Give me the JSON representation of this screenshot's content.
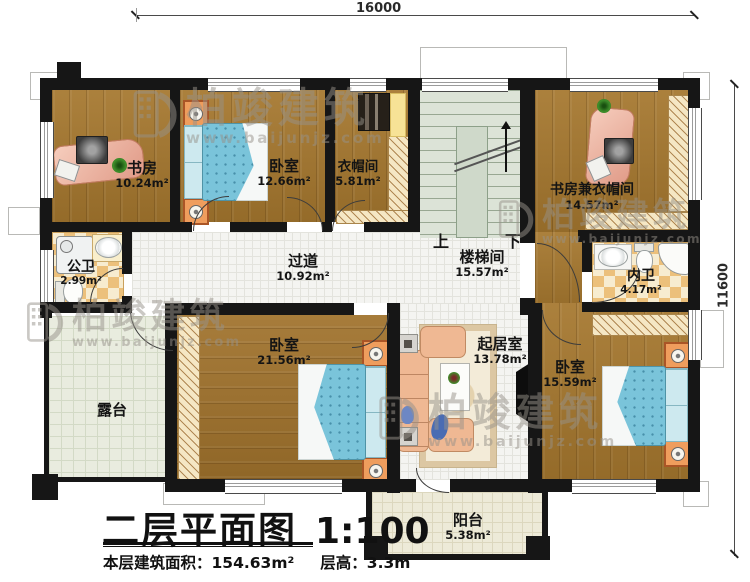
{
  "plan": {
    "dimensions": {
      "top": "16000",
      "right": "11600"
    },
    "title_block": {
      "title": "二层平面图",
      "scale": "1:100",
      "area_label": "本层建筑面积：",
      "area_value": "154.63m²",
      "height_label": "层高：",
      "height_value": "3.3m"
    },
    "stairs": {
      "up": "上",
      "down": "下"
    },
    "watermark": {
      "brand": "柏竣建筑",
      "url": "www.baijunjz.com"
    },
    "rooms": {
      "study": {
        "name": "书房",
        "area": "10.24m²"
      },
      "bedroom1": {
        "name": "卧室",
        "area": "12.66m²"
      },
      "cloakroom": {
        "name": "衣帽间",
        "area": "5.81m²"
      },
      "study_cloakroom": {
        "name": "书房兼衣帽间",
        "area": "14.57m²"
      },
      "public_bath": {
        "name": "公卫",
        "area": "2.99m²"
      },
      "corridor": {
        "name": "过道",
        "area": "10.92m²"
      },
      "stairwell": {
        "name": "楼梯间",
        "area": "15.57m²"
      },
      "private_bath": {
        "name": "内卫",
        "area": "4.17m²"
      },
      "terrace": {
        "name": "露台",
        "area": ""
      },
      "bedroom2": {
        "name": "卧室",
        "area": "21.56m²"
      },
      "living": {
        "name": "起居室",
        "area": "13.78m²"
      },
      "bedroom3": {
        "name": "卧室",
        "area": "15.59m²"
      },
      "balcony": {
        "name": "阳台",
        "area": "5.38m²"
      }
    },
    "colors": {
      "wall": "#161616",
      "wood_floor": "#a5772e",
      "bed_blue": "#7ac4da",
      "bath_checker": "#ecc07b",
      "stair_green": "#dce3d7",
      "desk_salmon": "#eebaa8",
      "sofa_salmon": "#efb893"
    }
  }
}
